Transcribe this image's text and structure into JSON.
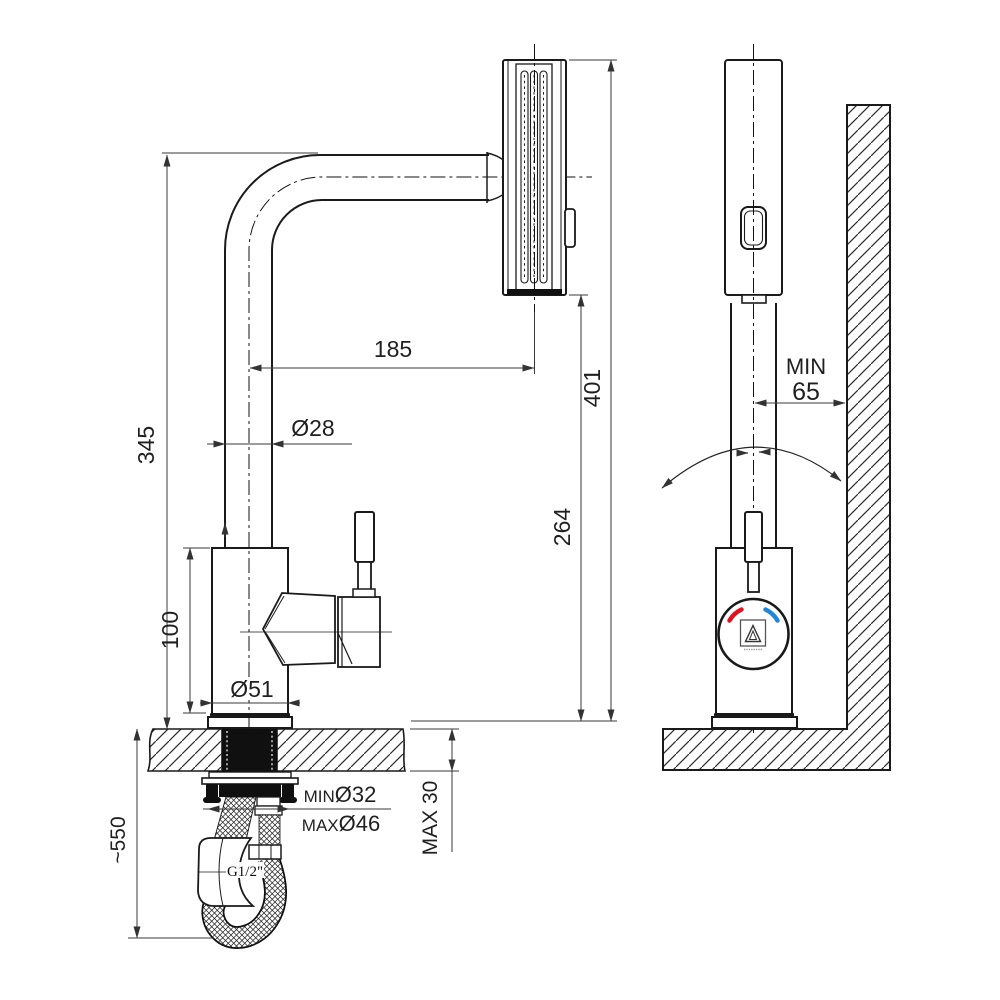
{
  "page": {
    "background": "#ffffff"
  },
  "drawing": {
    "type": "technical-dimension-drawing",
    "subject": "pull-out kitchen faucet, side view and front view with installation dimensions",
    "side_view": {
      "dim_spout_reach": "185",
      "dim_spout_height": "345",
      "dim_tube_diameter": "Ø28",
      "dim_body_height": "100",
      "dim_base_diameter": "Ø51",
      "dim_outlet_height": "264",
      "dim_total_height": "401",
      "dim_hole_min": {
        "prefix": "MIN",
        "value": "Ø32"
      },
      "dim_hole_max": {
        "prefix": "MAX",
        "value": "Ø46"
      },
      "dim_counter_thickness": "MAX 30",
      "dim_hose_length": "~550",
      "label_thread": "G1/2\""
    },
    "front_view": {
      "dim_wall_min_label": "MIN",
      "dim_wall_min_value": "65"
    },
    "colors": {
      "hot_indicator": "#e3101f",
      "cold_indicator": "#1f86d8",
      "outline": "#1a1a1a",
      "dim_line": "#3a3a3a"
    }
  }
}
